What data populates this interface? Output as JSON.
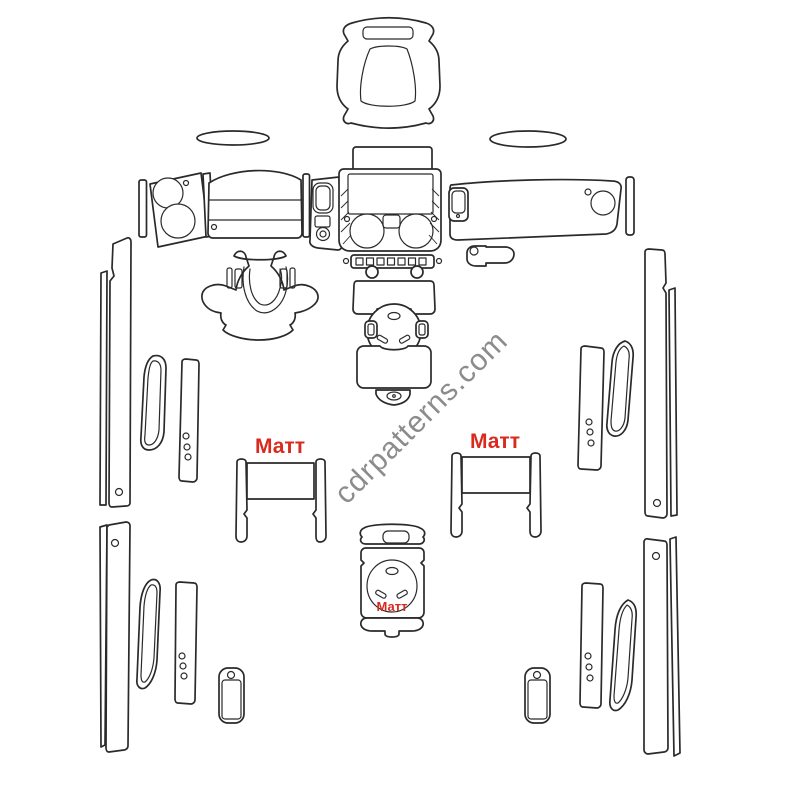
{
  "page": {
    "background_color": "#ffffff",
    "line_color": "#2a2a2a"
  },
  "watermark": {
    "text": "cdrpatterns.com",
    "color": "#8c8c8c",
    "rotation_deg": -45
  },
  "finish_labels": {
    "color": "#d92a1e",
    "items": [
      {
        "text": "Матт",
        "location": "left-seat-back-frame"
      },
      {
        "text": "Матт",
        "location": "right-seat-back-frame"
      },
      {
        "text": "Матт",
        "location": "rear-console-body"
      }
    ]
  },
  "diagram": {
    "kind": "vehicle-dash-trim-kit-cut-pattern",
    "pieces": [
      "overhead-console-trim",
      "left-defroster-ellipse",
      "right-defroster-ellipse",
      "center-upper-trim-plate",
      "driver-end-cap-strip",
      "instrument-cluster-bezel",
      "driver-dash-arc-panel",
      "column-side-strip",
      "column-switch-panel",
      "center-stack-bezel",
      "center-stack-button-strip",
      "console-knob-pair",
      "console-upper-panel",
      "shifter-ring",
      "shifter-side-clips",
      "console-lower-panel",
      "console-end-cap",
      "steering-column-horseshoe",
      "gearshift-bezel",
      "passenger-dash-panel",
      "passenger-end-cap-strip",
      "glovebox-handle",
      "front-left-pillar-strips",
      "rear-left-pillar-strips",
      "front-right-pillar-strips",
      "rear-right-pillar-strips",
      "front-left-door-pull",
      "front-left-door-strip",
      "rear-left-door-pull",
      "rear-left-door-strip",
      "front-right-door-pull",
      "front-right-door-strip",
      "rear-right-door-pull",
      "rear-right-door-strip",
      "left-seat-back-frame",
      "right-seat-back-frame",
      "rear-console-unit",
      "left-small-pillar-trim",
      "right-small-pillar-trim"
    ]
  }
}
